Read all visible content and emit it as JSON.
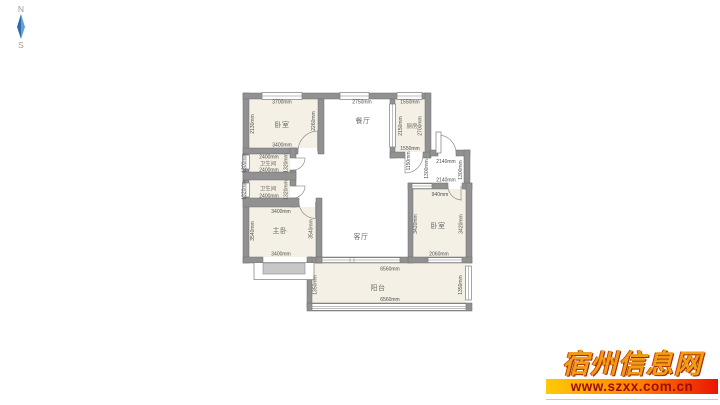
{
  "compass": {
    "north": "N",
    "south": "S",
    "needle_color": "#3c7ec0"
  },
  "colors": {
    "wall": "#919191",
    "room_fill": "#f4f0e5",
    "dim_text": "#4e4e4e",
    "watermark_title": "#f09d16",
    "watermark_bar_start": "#ffc908",
    "watermark_bar_end": "#ea1500",
    "watermark_url": "#9b0d00"
  },
  "floor_plan": {
    "bedroom_top_left": {
      "label": "卧室",
      "dim_top": "3700mm",
      "dim_bottom": "3400mm",
      "dim_left": "2130mm",
      "dim_right": "2260mm"
    },
    "dining": {
      "label": "餐厅",
      "dim_top": "2750mm"
    },
    "kitchen": {
      "label": "厨房",
      "dim_top": "1550mm",
      "dim_bottom": "1550mm",
      "dim_left": "2150mm",
      "dim_right": "2700mm"
    },
    "bath_upper": {
      "label": "卫生间",
      "dim_top": "2400mm",
      "dim_bottom": "2400mm",
      "dim_left": "1300mm",
      "dim_right": "1320mm"
    },
    "bath_lower": {
      "label": "卫生间",
      "dim_bottom": "2400mm",
      "dim_left": "1320mm",
      "dim_right": "1320mm"
    },
    "master_bedroom": {
      "label": "主卧",
      "dim_top": "3400mm",
      "dim_bottom": "3400mm",
      "dim_left": "3540mm",
      "dim_right": "3540mm"
    },
    "living": {
      "label": "客厅"
    },
    "entry_hall": {
      "dim_top": "2140mm",
      "dim_bottom": "2140mm",
      "dim_left": "1300mm",
      "dim_right": "1300mm",
      "dim_wall": "1150mm"
    },
    "bedroom_right": {
      "label": "卧室",
      "dim_top": "940mm",
      "dim_bottom": "2060mm",
      "dim_left": "3420mm",
      "dim_right": "3420mm"
    },
    "balcony": {
      "label": "阳台",
      "dim_top": "6560mm",
      "dim_bottom": "6560mm",
      "dim_left": "1350mm",
      "dim_right": "1350mm"
    }
  },
  "watermark": {
    "site_name": "宿州信息网",
    "url": "www.szxx.com.cn"
  }
}
